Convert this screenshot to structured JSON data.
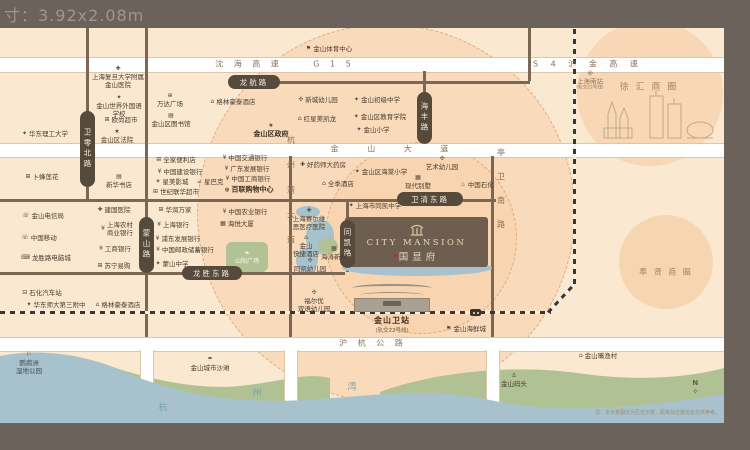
{
  "meta": {
    "size_label": "寸：3.92x2.08m",
    "note": "注：本示意图仅为区位示意，距离及位置信息仅供参考。",
    "compass_n": "N"
  },
  "project": {
    "name_en": "CITY MANSION",
    "name_cn": "国显府"
  },
  "station": {
    "name": "金山卫站",
    "sub": "(轨交22号线)"
  },
  "plaza": {
    "label": "山阳广场",
    "leaf_icon": "❧",
    "color": "#b2c295"
  },
  "colors": {
    "frame": "#6a625b",
    "map": "#fbe8d1",
    "road_pill": "#564a3d",
    "project_block": "#6d5e50",
    "water": "#a7c2cc",
    "green": "#b0c193",
    "accent_red": "#a33b2c"
  },
  "road_pills": [
    {
      "id": "weiling-north-road",
      "text": "卫零北路",
      "x": 80,
      "y": 111,
      "w": 15,
      "h": 76,
      "v": true
    },
    {
      "id": "mengshan-road",
      "text": "蒙山路",
      "x": 139,
      "y": 217,
      "w": 15,
      "h": 56,
      "v": true
    },
    {
      "id": "haifeng-road",
      "text": "海丰路",
      "x": 417,
      "y": 92,
      "w": 15,
      "h": 52,
      "v": true
    },
    {
      "id": "tongkai-road",
      "text": "同凯路",
      "x": 340,
      "y": 220,
      "w": 15,
      "h": 48,
      "v": true
    },
    {
      "id": "longhang-road",
      "text": "龙航路",
      "x": 228,
      "y": 75,
      "w": 52,
      "h": 14
    },
    {
      "id": "weiqing-east-road",
      "text": "卫清东路",
      "x": 397,
      "y": 192,
      "w": 66,
      "h": 14
    },
    {
      "id": "longsheng-east-road",
      "text": "龙胜东路",
      "x": 182,
      "y": 266,
      "w": 60,
      "h": 14
    }
  ],
  "road_texts": [
    {
      "id": "shenhai-expressway",
      "text": "沈 海 高 速",
      "x": 249,
      "y": 64,
      "ls": 4
    },
    {
      "id": "g15",
      "text": "G 1 5",
      "x": 334,
      "y": 64,
      "ls": 4
    },
    {
      "id": "s4-hujin-expressway",
      "text": "S 4 沪 金 高 速",
      "x": 588,
      "y": 64,
      "ls": 5
    },
    {
      "id": "jinshan-avenue",
      "text": "金 山 大 道",
      "x": 396,
      "y": 149,
      "ls": 13
    },
    {
      "id": "huhang-highway",
      "text": "沪 杭 公 路",
      "x": 373,
      "y": 343,
      "ls": 4
    },
    {
      "id": "hangzhouwan-avenue",
      "text": "杭州湾大道",
      "x": 291,
      "y": 198,
      "ls": 17,
      "v": true
    },
    {
      "id": "tingwei-south-road",
      "text": "亭卫南路",
      "x": 501,
      "y": 196,
      "ls": 16,
      "v": true
    }
  ],
  "area_labels": [
    {
      "id": "xuhui-business-circle",
      "text": "徐 汇 商 圈",
      "x": 649,
      "y": 86,
      "size": 9,
      "ls": 2
    },
    {
      "id": "fengxian-business-circle",
      "text": "奉 贤 商 圈",
      "x": 666,
      "y": 272,
      "size": 8,
      "ls": 2
    }
  ],
  "water_chars": [
    {
      "ch": "杭",
      "x": 163,
      "y": 407
    },
    {
      "ch": "州",
      "x": 257,
      "y": 392
    },
    {
      "ch": "湾",
      "x": 352,
      "y": 386
    }
  ],
  "pois": [
    {
      "id": "fudan-jinshan-hospital",
      "lines": [
        "上海复旦大学附属",
        "金山医院"
      ],
      "icon": "hospital",
      "x": 118,
      "y": 77,
      "top": true
    },
    {
      "id": "jinshan-world-foreign-language-school",
      "lines": [
        "金山世界外国语",
        "学校"
      ],
      "icon": "school",
      "x": 119,
      "y": 106,
      "top": true
    },
    {
      "id": "auchan-supermarket",
      "lines": [
        "欧尚超市"
      ],
      "icon": "cart",
      "x": 121,
      "y": 120
    },
    {
      "id": "jinshan-district-court",
      "lines": [
        "金山区法院"
      ],
      "icon": "court",
      "x": 117,
      "y": 136,
      "top": true
    },
    {
      "id": "east-china-univ-science-tech",
      "lines": [
        "华东理工大学"
      ],
      "icon": "school",
      "x": 45,
      "y": 134
    },
    {
      "id": "wanda-plaza",
      "lines": [
        "万达广场"
      ],
      "icon": "mall",
      "x": 170,
      "y": 100,
      "top": true
    },
    {
      "id": "jinshan-district-library",
      "lines": [
        "金山区图书馆"
      ],
      "icon": "library",
      "x": 171,
      "y": 120,
      "top": true
    },
    {
      "id": "greentree-inn-north",
      "lines": [
        "格林豪泰酒店"
      ],
      "icon": "hotel",
      "x": 233,
      "y": 102
    },
    {
      "id": "jinshan-sports-center",
      "lines": [
        "金山体育中心"
      ],
      "icon": "flag",
      "x": 329,
      "y": 49
    },
    {
      "id": "jinshan-district-government",
      "lines": [
        "金山区政府"
      ],
      "icon": "gov",
      "x": 271,
      "y": 130,
      "top": true,
      "bold": true
    },
    {
      "id": "xincheng-kindergarten",
      "lines": [
        "新城幼儿园"
      ],
      "icon": "pinwheel",
      "x": 318,
      "y": 100
    },
    {
      "id": "red-star-macalline",
      "lines": [
        "红星美凯龙"
      ],
      "icon": "home",
      "x": 317,
      "y": 119
    },
    {
      "id": "jinshan-junior-middle-school",
      "lines": [
        "金山初级中学"
      ],
      "icon": "school",
      "x": 377,
      "y": 100
    },
    {
      "id": "jinshan-education-institute",
      "lines": [
        "金山区教育学院"
      ],
      "icon": "school",
      "x": 380,
      "y": 117
    },
    {
      "id": "jinshan-primary-school",
      "lines": [
        "金山小学"
      ],
      "icon": "school",
      "x": 373,
      "y": 130
    },
    {
      "id": "lotus-supermarket",
      "lines": [
        "卜蜂莲花"
      ],
      "icon": "cart",
      "x": 42,
      "y": 177
    },
    {
      "id": "xinhua-bookstore",
      "lines": [
        "新华书店"
      ],
      "icon": "book",
      "x": 119,
      "y": 181,
      "top": true
    },
    {
      "id": "familymart",
      "lines": [
        "全家便利店"
      ],
      "icon": "store",
      "x": 176,
      "y": 160
    },
    {
      "id": "china-construction-bank",
      "lines": [
        "中国建设银行"
      ],
      "icon": "bank",
      "x": 180,
      "y": 172
    },
    {
      "id": "stellar-cinema",
      "lines": [
        "星美影城"
      ],
      "icon": "cinema",
      "x": 172,
      "y": 182
    },
    {
      "id": "starbucks",
      "lines": [
        "星巴克"
      ],
      "icon": "coffee",
      "x": 210,
      "y": 182
    },
    {
      "id": "lianhua-supermarket",
      "lines": [
        "世纪联华超市"
      ],
      "icon": "cart",
      "x": 176,
      "y": 192
    },
    {
      "id": "bank-of-communications",
      "lines": [
        "中国交通银行"
      ],
      "icon": "bank",
      "x": 245,
      "y": 158
    },
    {
      "id": "guangdong-development-bank",
      "lines": [
        "广东发展银行"
      ],
      "icon": "bank",
      "x": 247,
      "y": 169
    },
    {
      "id": "icbc-bank-north",
      "lines": [
        "中国工商银行"
      ],
      "icon": "bank",
      "x": 248,
      "y": 179
    },
    {
      "id": "bailian-shopping-center",
      "lines": [
        "百联购物中心"
      ],
      "icon": "mall",
      "x": 249,
      "y": 190,
      "bold": true
    },
    {
      "id": "jinshan-telecom",
      "lines": [
        "金山电信局"
      ],
      "icon": "phone",
      "x": 43,
      "y": 216
    },
    {
      "id": "china-mobile",
      "lines": [
        "中国移动"
      ],
      "icon": "phone",
      "x": 39,
      "y": 238
    },
    {
      "id": "longsheng-computer-city",
      "lines": [
        "龙胜路电脑城"
      ],
      "icon": "computer",
      "x": 46,
      "y": 258
    },
    {
      "id": "jianguo-hospital",
      "lines": [
        "建国医院"
      ],
      "icon": "hospital",
      "x": 114,
      "y": 210
    },
    {
      "id": "shanghai-rural-commercial-bank",
      "lines": [
        "上海农村",
        "商业银行"
      ],
      "icon": "bank",
      "x": 117,
      "y": 229
    },
    {
      "id": "icbc-bank-south",
      "lines": [
        "工商银行"
      ],
      "icon": "bank",
      "x": 115,
      "y": 249
    },
    {
      "id": "suning",
      "lines": [
        "苏宁易购"
      ],
      "icon": "store",
      "x": 114,
      "y": 266
    },
    {
      "id": "china-resources-vanguard",
      "lines": [
        "华润万家"
      ],
      "icon": "cart",
      "x": 175,
      "y": 210
    },
    {
      "id": "bank-of-shanghai",
      "lines": [
        "上海银行"
      ],
      "icon": "bank",
      "x": 173,
      "y": 225
    },
    {
      "id": "spd-bank",
      "lines": [
        "浦东发展银行"
      ],
      "icon": "bank",
      "x": 178,
      "y": 239
    },
    {
      "id": "postal-savings-bank",
      "lines": [
        "中国邮政储蓄银行"
      ],
      "icon": "bank",
      "x": 185,
      "y": 250
    },
    {
      "id": "mengshan-middle-school",
      "lines": [
        "蒙山中学"
      ],
      "icon": "school",
      "x": 172,
      "y": 264
    },
    {
      "id": "agricultural-bank-of-china",
      "lines": [
        "中国农业银行"
      ],
      "icon": "bank",
      "x": 245,
      "y": 212
    },
    {
      "id": "haiyue-building",
      "lines": [
        "海悦大厦"
      ],
      "icon": "building",
      "x": 237,
      "y": 224
    },
    {
      "id": "shihua-bus-station",
      "lines": [
        "石化汽车站"
      ],
      "icon": "bus",
      "x": 42,
      "y": 293
    },
    {
      "id": "ecnu-third-affiliated-school",
      "lines": [
        "华东师大第三附中"
      ],
      "icon": "school",
      "x": 56,
      "y": 305
    },
    {
      "id": "greentree-inn-south",
      "lines": [
        "格林豪泰酒店"
      ],
      "icon": "hotel",
      "x": 118,
      "y": 305
    },
    {
      "id": "haoyaoshi-pharmacy",
      "lines": [
        "好药师大药房"
      ],
      "icon": "hospital",
      "x": 323,
      "y": 165
    },
    {
      "id": "ji-hotel",
      "lines": [
        "全季酒店"
      ],
      "icon": "hotel",
      "x": 338,
      "y": 184
    },
    {
      "id": "haitang-primary-school",
      "lines": [
        "金山区海棠小学"
      ],
      "icon": "school",
      "x": 381,
      "y": 172
    },
    {
      "id": "art-kindergarten",
      "lines": [
        "艺术幼儿园"
      ],
      "icon": "pinwheel",
      "x": 442,
      "y": 163,
      "top": true
    },
    {
      "id": "modern-villa",
      "lines": [
        "现代别墅"
      ],
      "icon": "building",
      "x": 418,
      "y": 182,
      "top": true
    },
    {
      "id": "sinopec-gas",
      "lines": [
        "中国石化"
      ],
      "icon": "gas",
      "x": 477,
      "y": 185
    },
    {
      "id": "tongkai-middle-school",
      "lines": [
        "上海市同凯中学"
      ],
      "icon": "school",
      "x": 375,
      "y": 206
    },
    {
      "id": "seerweisi-hospital",
      "lines": [
        "上海赛尔维",
        "思医疗医院"
      ],
      "icon": "hospital",
      "x": 309,
      "y": 219,
      "top": true
    },
    {
      "id": "jinshan-express-hotel",
      "lines": [
        "金山",
        "快捷酒店"
      ],
      "icon": "hotel",
      "x": 306,
      "y": 246,
      "top": true
    },
    {
      "id": "haitao-xincun",
      "lines": [
        "海涛新村"
      ],
      "icon": "building",
      "x": 334,
      "y": 253,
      "top": true
    },
    {
      "id": "tongkai-kindergarten",
      "lines": [
        "同凯幼儿园"
      ],
      "icon": "pinwheel",
      "x": 310,
      "y": 265,
      "top": true
    },
    {
      "id": "fueryou-bilingual-kindergarten",
      "lines": [
        "福尔优",
        "双语幼儿园"
      ],
      "icon": "pinwheel",
      "x": 314,
      "y": 301,
      "top": true
    },
    {
      "id": "jinshan-seafood-city",
      "lines": [
        "金山海鲜城"
      ],
      "icon": "flag",
      "x": 466,
      "y": 329
    },
    {
      "id": "jinshanzui-fishing-village",
      "lines": [
        "金山嘴渔村"
      ],
      "icon": "home",
      "x": 598,
      "y": 356
    },
    {
      "id": "jinshan-pier",
      "lines": [
        "金山码头"
      ],
      "icon": "ship",
      "x": 514,
      "y": 380,
      "top": true
    },
    {
      "id": "jinshan-city-beach",
      "lines": [
        "金山城市沙滩"
      ],
      "icon": "umbrella",
      "x": 210,
      "y": 364,
      "top": true
    },
    {
      "id": "yingwuzhou-wetland-park",
      "lines": [
        "鹦鹉洲",
        "湿地公园"
      ],
      "icon": "bird",
      "x": 29,
      "y": 363,
      "top": true,
      "color": "#3e4f58"
    },
    {
      "id": "shanghai-south-railway-station",
      "lines": [
        "上海南站"
      ],
      "sub": "(轨交22号线)",
      "icon": "metro",
      "x": 590,
      "y": 80,
      "top": true,
      "color": "#9b7055"
    }
  ]
}
